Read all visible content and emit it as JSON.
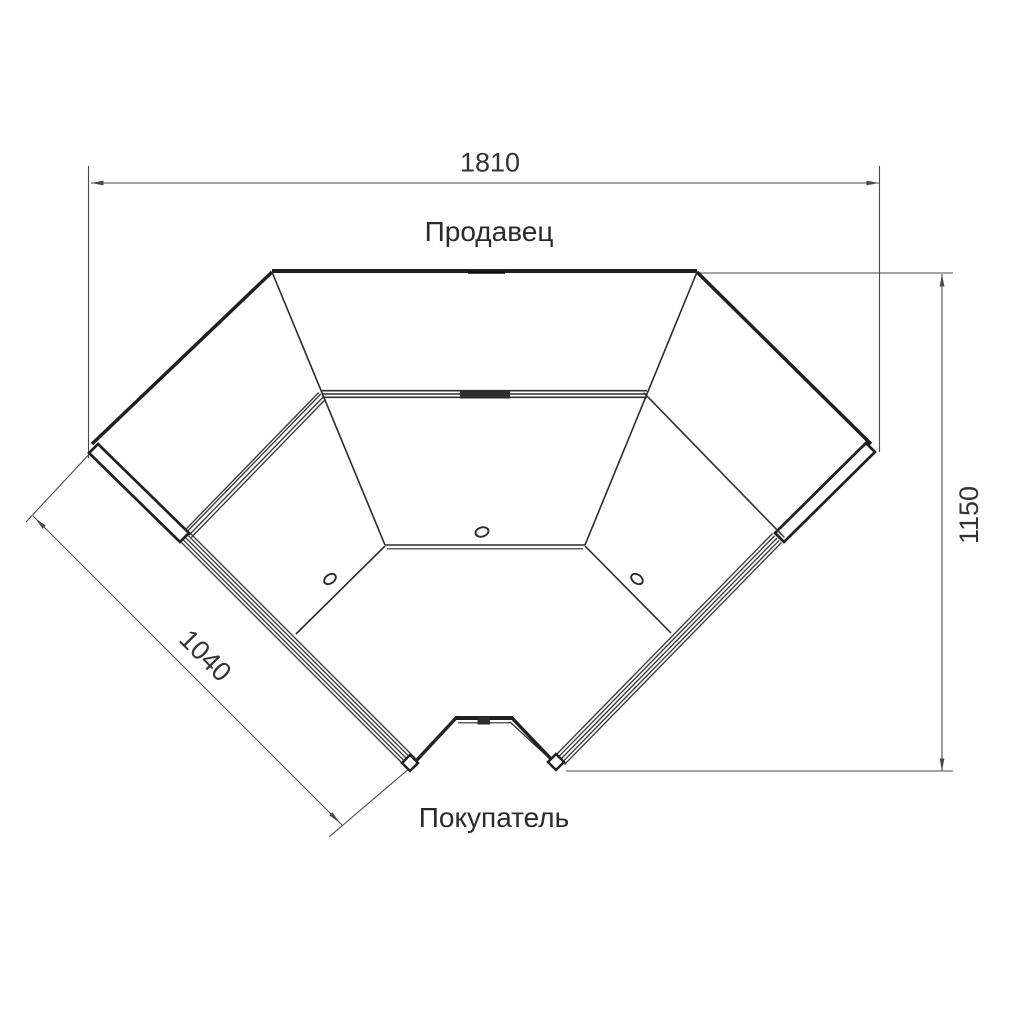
{
  "drawing": {
    "kind": "corner-counter-plan-view",
    "labels": {
      "seller": "Продавец",
      "buyer": "Покупатель"
    },
    "dimensions": {
      "width_mm": "1810",
      "side_mm": "1040",
      "height_mm": "1150"
    },
    "colors": {
      "outline": "#1f1f1f",
      "detail": "#2e2e2e",
      "dimension": "#4a4a4a",
      "text": "#2b2b2b",
      "background": "#ffffff"
    }
  }
}
